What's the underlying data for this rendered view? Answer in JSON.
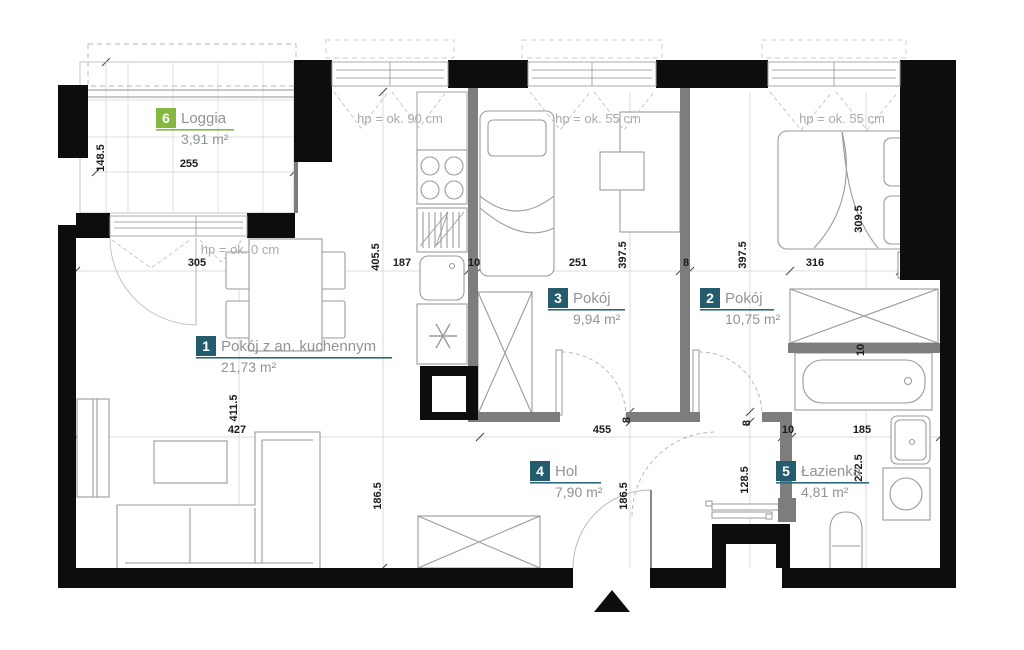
{
  "colors": {
    "badge_teal": "#245c6e",
    "badge_green": "#84b841",
    "underline_teal": "#2e6a7d",
    "underline_green": "#84b841",
    "wall_black": "#0d0d0d",
    "wall_gray": "#7d7d7d",
    "label_text": "#8f9498",
    "hp_text": "#a6abae",
    "dim_text": "#1c1c1c"
  },
  "rooms": [
    {
      "number": "1",
      "name": "Pokój z an. kuchennym",
      "area": "21,73 m²"
    },
    {
      "number": "2",
      "name": "Pokój",
      "area": "10,75 m²"
    },
    {
      "number": "3",
      "name": "Pokój",
      "area": "9,94 m²"
    },
    {
      "number": "4",
      "name": "Hol",
      "area": "7,90 m²"
    },
    {
      "number": "5",
      "name": "Łazienka",
      "area": "4,81 m²"
    },
    {
      "number": "6",
      "name": "Loggia",
      "area": "3,91 m²"
    }
  ],
  "window_labels": {
    "kitchen": "hp = ok. 90 cm",
    "room3": "hp = ok. 55 cm",
    "room2": "hp = ok. 55 cm",
    "balcony": "hp = ok. 0 cm"
  },
  "dimensions": {
    "loggia_depth": "148.5",
    "loggia_width": "255",
    "balcony_opening": "305",
    "kitchen_depth": "405.5",
    "kitchen_width": "187",
    "kitchen_wall": "10",
    "room3_width": "251",
    "room3_depth": "397.5",
    "room23_wall": "8",
    "room2_depth": "397.5",
    "room2_width": "316",
    "room2_inner": "309.5",
    "room1_depth": "411.5",
    "room1_width": "427",
    "hol_width": "455",
    "bath_wall": "10",
    "bath_width": "185",
    "room1_lower_depth": "186.5",
    "hol_depth": "186.5",
    "bath_entry": "128.5",
    "bath_depth": "272.5",
    "bath_top_wall": "10",
    "hol_wall": "8",
    "room2_door_wall": "8"
  }
}
